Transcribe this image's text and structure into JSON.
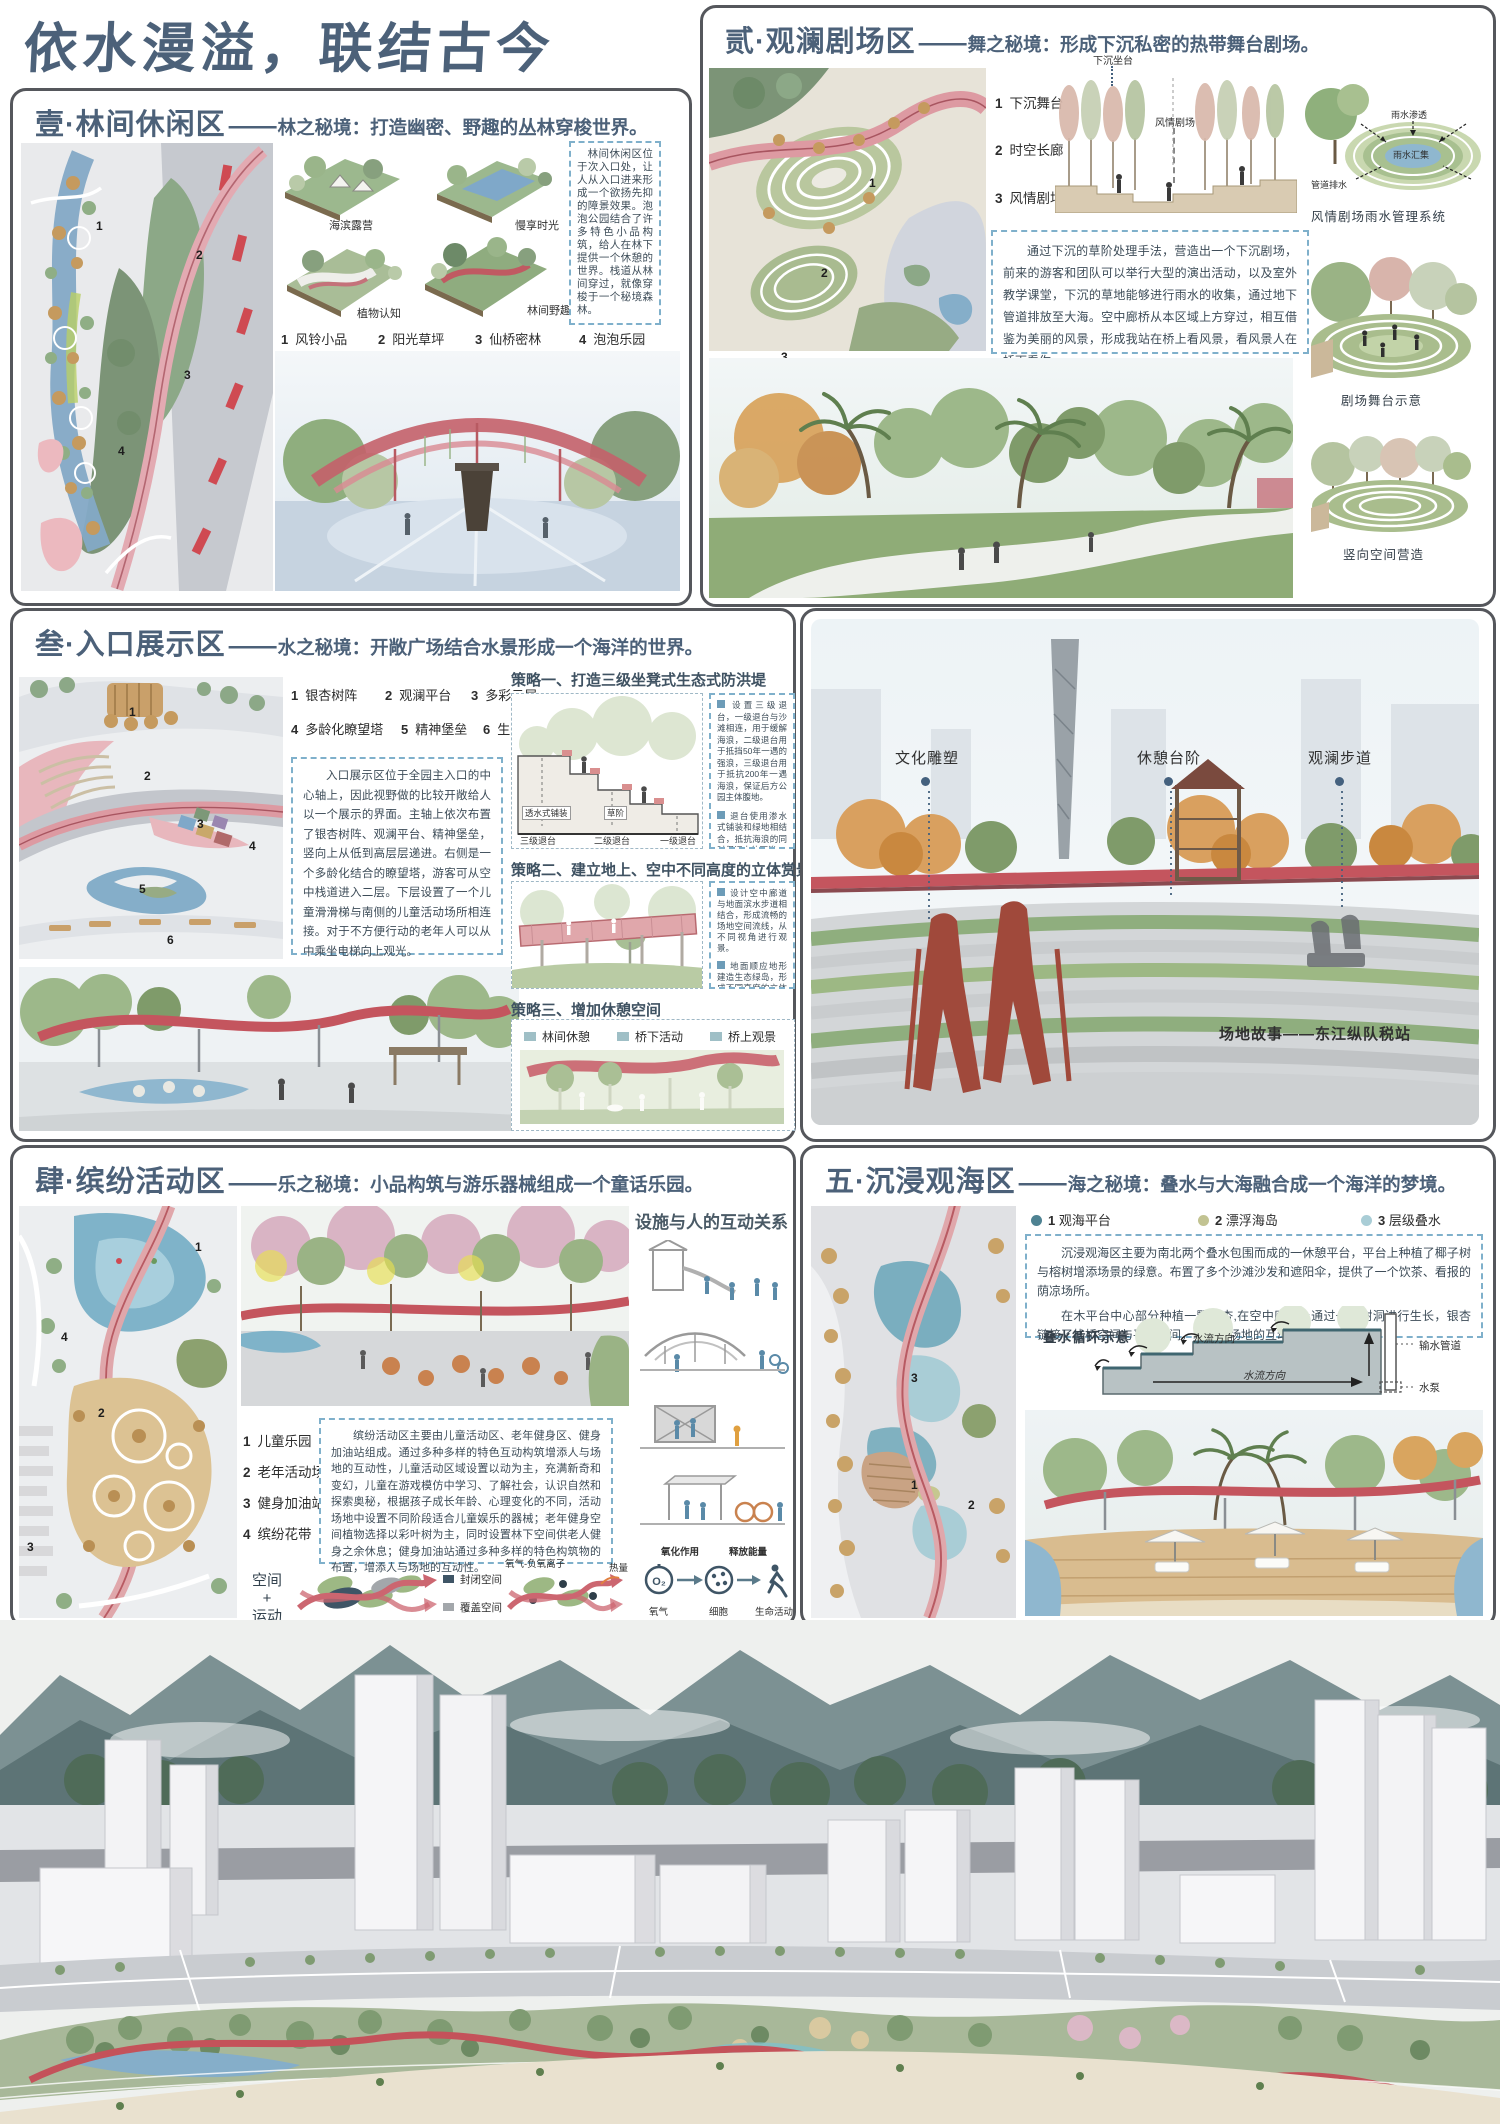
{
  "poster": {
    "title": "依水漫溢，联结古今",
    "separator": "——",
    "accent_red": "#c4555e",
    "header_blue": "#4c6179",
    "note_border_blue": "#7fb0cb"
  },
  "section1": {
    "num_name": "壹·林间休闲区",
    "subtitle": "林之秘境：打造幽密、野趣的丛林穿梭世界。",
    "axon_labels": [
      "海滨露营",
      "慢享时光",
      "植物认知",
      "林间野趣"
    ],
    "legend": [
      {
        "num": "1",
        "label": "风铃小品"
      },
      {
        "num": "2",
        "label": "阳光草坪"
      },
      {
        "num": "3",
        "label": "仙桥密林"
      },
      {
        "num": "4",
        "label": "泡泡乐园"
      }
    ],
    "plan_numbers": [
      "1",
      "2",
      "3",
      "4"
    ],
    "description": "林间休闲区位于次入口处，让人从入口进来形成一个欲扬先抑的障景效果。泡泡公园结合了许多特色小品构筑，给人在林下提供一个休憩的世界。栈道从林间穿过，就像穿梭于一个秘境森林。"
  },
  "section2": {
    "num_name": "贰·观澜剧场区",
    "subtitle": "舞之秘境：形成下沉私密的热带舞台剧场。",
    "legend": [
      {
        "num": "1",
        "label": "下沉舞台"
      },
      {
        "num": "2",
        "label": "时空长廊"
      },
      {
        "num": "3",
        "label": "风情剧场"
      }
    ],
    "plan_numbers": [
      "1",
      "2",
      "3"
    ],
    "section_label_top": "下沉坐台",
    "section_label_mid": "风情剧场",
    "description": "通过下沉的草阶处理手法，营造出一个下沉剧场，前来的游客和团队可以举行大型的演出活动，以及室外教学课堂，下沉的草地能够进行雨水的收集，通过地下管道排放至大海。空中廊桥从本区域上方穿过，相互借鉴为美丽的风景，形成我站在桥上看风景，看风景人在桥下看你。",
    "rain_labels": [
      "雨水渗透",
      "雨水汇集",
      "管道排水"
    ],
    "caption_rain": "风情剧场雨水管理系统",
    "caption_stage": "剧场舞台示意",
    "caption_vertical": "竖向空间营造"
  },
  "section3": {
    "num_name": "叁·入口展示区",
    "subtitle": "水之秘境：开敞广场结合水景形成一个海洋的世界。",
    "legend": [
      {
        "num": "1",
        "label": "银杏树阵"
      },
      {
        "num": "2",
        "label": "观澜平台"
      },
      {
        "num": "3",
        "label": "多彩云屋"
      },
      {
        "num": "4",
        "label": "多龄化瞭望塔"
      },
      {
        "num": "5",
        "label": "精神堡垒"
      },
      {
        "num": "6",
        "label": "生态退台"
      }
    ],
    "plan_numbers": [
      "1",
      "2",
      "3",
      "4",
      "5",
      "6"
    ],
    "description": "入口展示区位于全园主入口的中心轴上，因此视野做的比较开敞给人以一个展示的界面。主轴上依次布置了银杏树阵、观澜平台、精神堡垒，竖向上从低到高层层递进。右侧是一个多龄化结合的瞭望塔，游客可从空中栈道进入二层。下层设置了一个儿童滑滑梯与南侧的儿童活动场所相连接。对于不方便行动的老年人可以从中乘坐电梯向上观光。",
    "strategy1": {
      "title": "策略一、打造三级坐凳式生态式防洪堤",
      "notes": [
        "设置三级退台，一级退台与沙滩相连，用于缓解海浪，二级退台用于抵挡50年一遇的强浪，三级退台用于抵抗200年一遇海浪，保证后方公园主体腹地。",
        "退台使用渗水式铺装和绿地相结合，抵抗海浪的同时保证水体下渗。"
      ],
      "small_labels": [
        "透水式铺装",
        "草阶"
      ],
      "step_labels": [
        "三级退台",
        "二级退台",
        "一级退台"
      ]
    },
    "strategy2": {
      "title": "策略二、建立地上、空中不同高度的立体赏景视角。",
      "notes": [
        "设计空中廊道与地面滨水步道相结合，形成流畅的场地空间流线，从不同视角进行观景。",
        "地面顺应地形建造生态绿岛，形成不同高度的立体空间，增加空间的丰富性。"
      ]
    },
    "strategy3": {
      "title": "策略三、增加休憩空间",
      "legend": [
        "林间休憩",
        "桥下活动",
        "桥上观景"
      ]
    },
    "photo_labels": [
      "文化雕塑",
      "休憩台阶",
      "观澜步道"
    ],
    "photo_caption": "场地故事——东江纵队税站"
  },
  "section4": {
    "num_name": "肆·缤纷活动区",
    "subtitle": "乐之秘境：小品构筑与游乐器械组成一个童话乐园。",
    "legend": [
      {
        "num": "1",
        "label": "儿童乐园"
      },
      {
        "num": "2",
        "label": "老年活动场"
      },
      {
        "num": "3",
        "label": "健身加油站"
      },
      {
        "num": "4",
        "label": "缤纷花带"
      }
    ],
    "plan_numbers": [
      "1",
      "4",
      "2",
      "3"
    ],
    "interaction_title": "设施与人的互动关系",
    "description": "缤纷活动区主要由儿童活动区、老年健身区、健身加油站组成。通过多种多样的特色互动构筑增添人与场地的互动性，儿童活动区域设置以动为主，充满新奇和变幻，儿童在游戏模仿中学习、了解社会，认识自然和探索奥秘，根据孩子成长年龄、心理变化的不同，活动场地中设置不同阶段适合儿童娱乐的器械；老年健身空间植物选择以彩叶树为主，同时设置林下空间供老人健身之余休息；健身加油站通过多种多样的特色构筑物的布置，增添人与场地的互动性。",
    "space_motion": [
      "空间",
      "+",
      "运动"
    ],
    "space_legend": [
      "封闭空间",
      "覆盖空间"
    ],
    "flow_label_top": "氧气-负氧离子",
    "flow_label_heat": "热量",
    "oxygen_top_labels": [
      "氧化作用",
      "释放能量"
    ],
    "oxygen_bottom_labels": [
      "氧气",
      "细胞",
      "生命活动"
    ],
    "oxygen_icon": "O₂"
  },
  "section5": {
    "num_name": "五·沉浸观海区",
    "subtitle": "海之秘境：叠水与大海融合成一个海洋的梦境。",
    "legend": [
      {
        "num": "1",
        "label": "观海平台",
        "color": "#4e8292"
      },
      {
        "num": "2",
        "label": "漂浮海岛",
        "color": "#c2c392"
      },
      {
        "num": "3",
        "label": "层级叠水",
        "color": "#a9cdd6"
      }
    ],
    "plan_numbers": [
      "1",
      "2",
      "3"
    ],
    "description1": "沉浸观海区主要为南北两个叠水包围而成的一休憩平台，平台上种植了椰子树与榕树增添场景的绿意。布置了多个沙滩沙发和遮阳伞，提供了一个饮茶、看报的荫凉场所。",
    "description2": "在木平台中心部分种植一颗银杏,在空中廊桥上通过一个树洞进行生长，银杏链接了栈桥空间与平台空间，增加了场地的互动性与趣味性。",
    "cascade_title": "叠水循环示意",
    "cascade_flow_labels": [
      "水流方向",
      "水流方向"
    ],
    "cascade_side_labels": [
      "输水管道",
      "水泵"
    ]
  }
}
